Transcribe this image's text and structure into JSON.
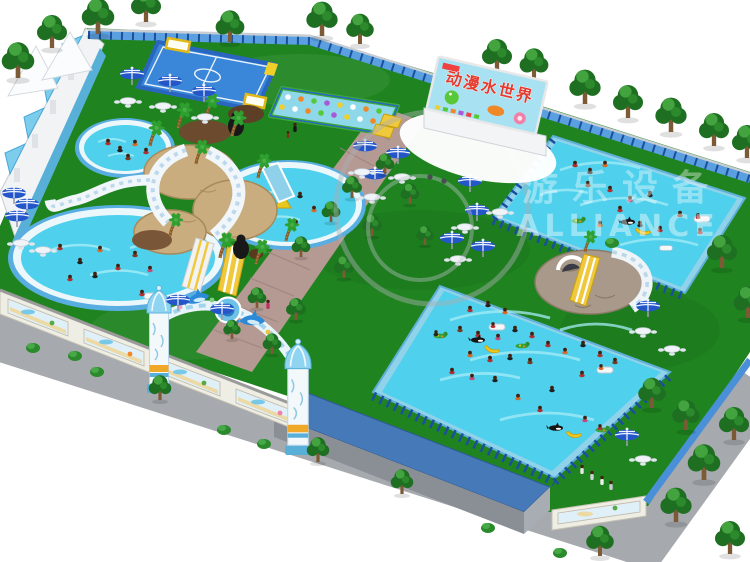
{
  "scene": {
    "description": "aerial 3d render of inflatable water park",
    "billboard": {
      "title": "动漫水世界"
    },
    "watermark": {
      "zh": "游乐设备",
      "en": "ALLIANCE"
    }
  },
  "palette": {
    "grass": "#1f8420",
    "grassLight": "#2f9c2f",
    "water": "#4fd0ec",
    "waterDeep": "#2fb6e0",
    "poolRim": "#ecf7fb",
    "frameBlue": "#8fd2ea",
    "frameDark": "#1b4f9e",
    "walkway": "#b59a93",
    "sidewalk": "#a6a9ad",
    "treeDark": "#1e6f22",
    "treeLight": "#43a33f",
    "trunk": "#7c5a36",
    "umbrella": "#2456c8",
    "slideYellow": "#f0c83c",
    "stone": "#c9ad7e",
    "rock": "#6b4a2e",
    "roofBlue": "#4579b8",
    "wallWhite": "#f1f3f5",
    "fenceBlue": "#4a90d8",
    "archBlue": "#79c9ea",
    "billboardSky": "#a8e2f2",
    "titleRed": "#e33b2f",
    "banana": "#f2c81e",
    "orca": "#151515"
  }
}
